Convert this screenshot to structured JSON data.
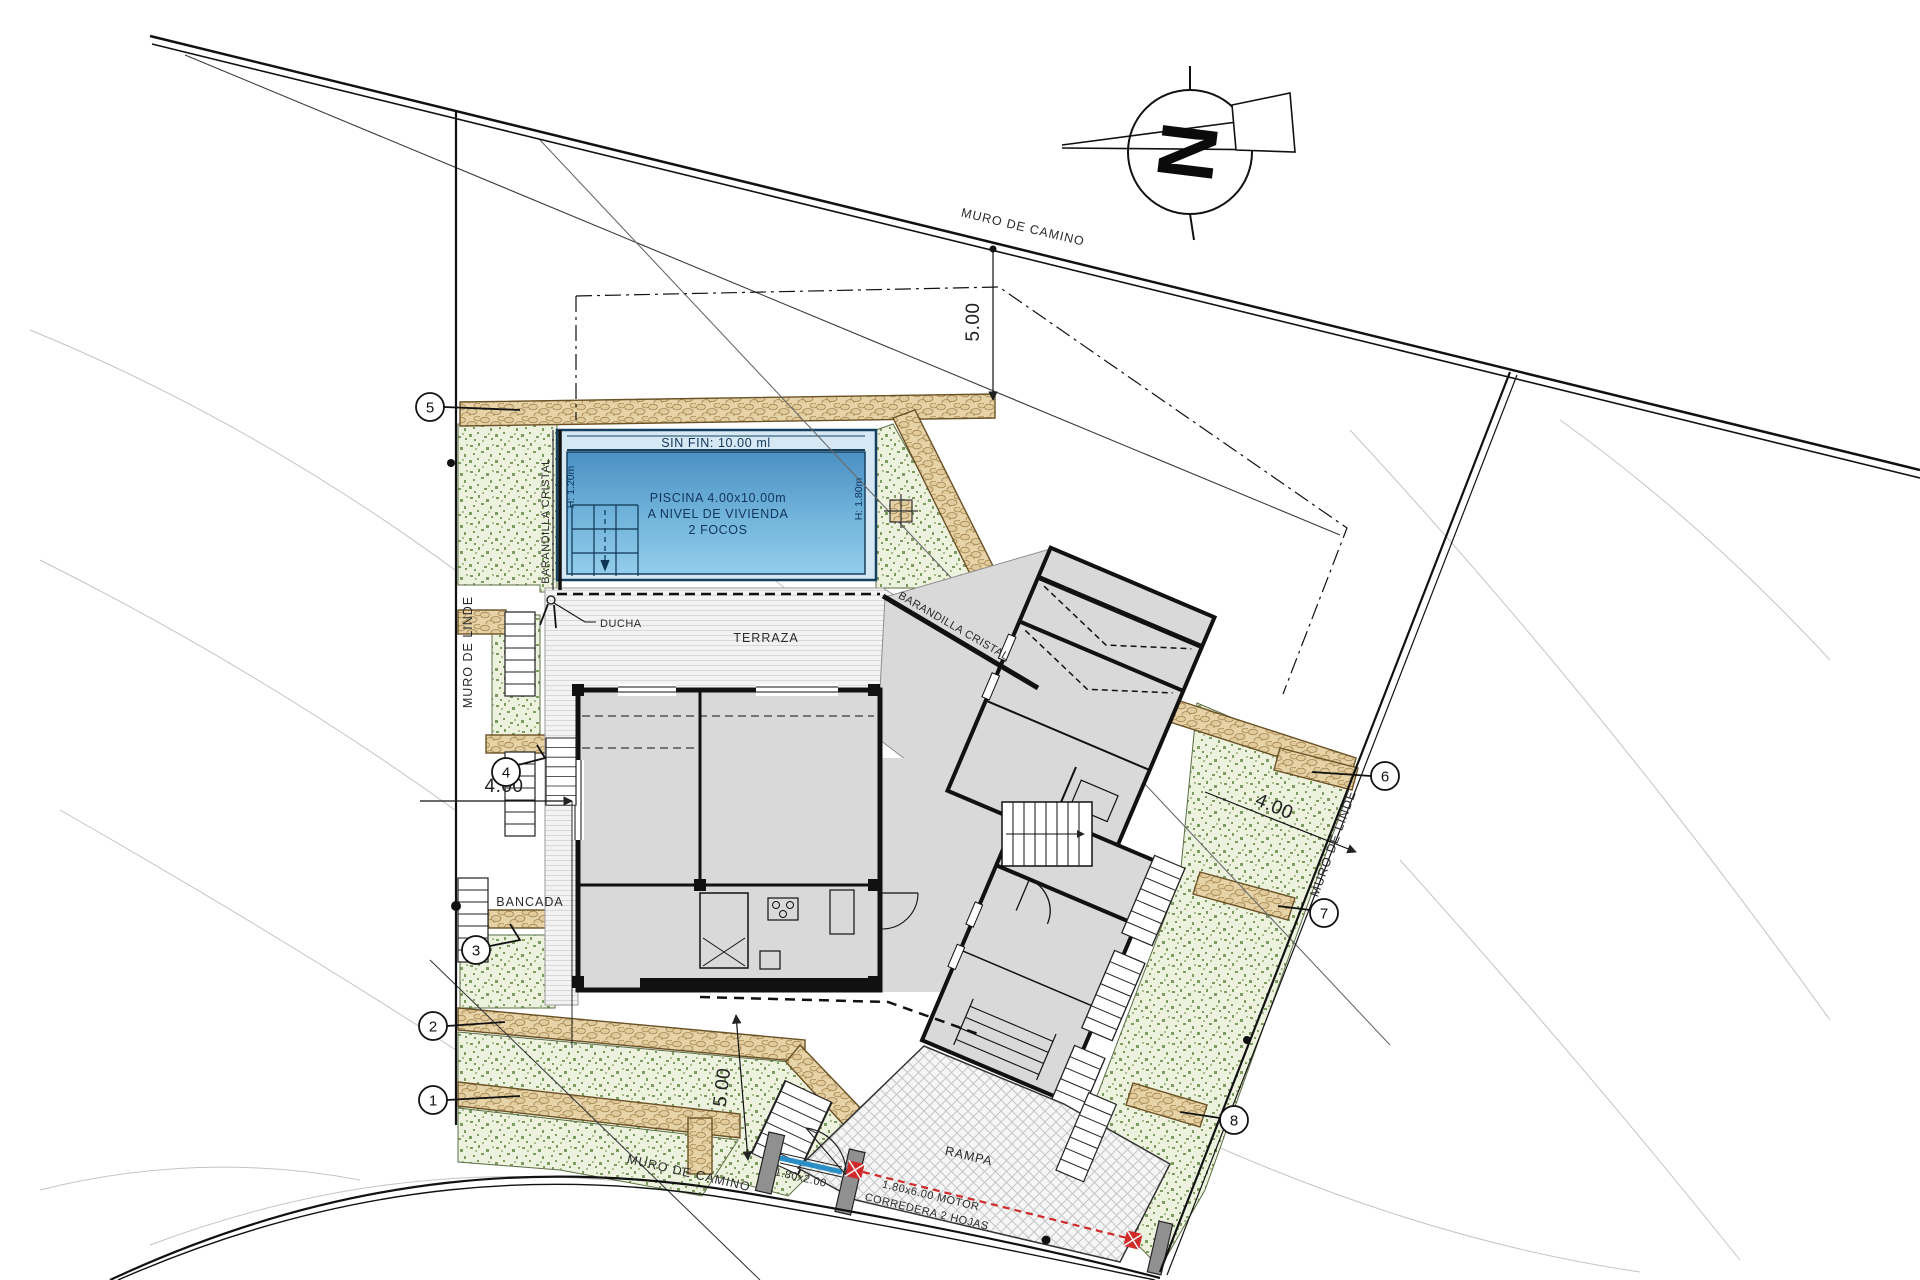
{
  "compass": {
    "north": "N"
  },
  "roads": {
    "top": "MURO DE CAMINO",
    "bottom": "MURO DE CAMINO"
  },
  "boundaries": {
    "left": "MURO DE LINDE",
    "right": "MURO DE LINDE"
  },
  "pool": {
    "edge": "SIN FIN: 10.00 ml",
    "name": "PISCINA 4.00x10.00m",
    "level": "A NIVEL DE VIVIENDA",
    "lights": "2 FOCOS",
    "depth_shallow": "H: 1.20m",
    "depth_deep": "H: 1.80m",
    "railing": "BARANDILLA CRISTAL"
  },
  "terrace": {
    "label": "TERRAZA",
    "railing": "BARANDILLA CRISTAL",
    "shower": "DUCHA",
    "bench": "BANCADA"
  },
  "ramp": {
    "label": "RAMPA"
  },
  "gates": {
    "pedestrian_size": "1.80x2.00",
    "sliding_size": "1.80x6.00 MOTOR",
    "sliding_type": "CORREDERA 2 HOJAS"
  },
  "dimensions": {
    "top_setback": "5.00",
    "left_width": "4.00",
    "right_setback": "4.00",
    "bottom_setback": "5.00"
  },
  "markers": [
    "1",
    "2",
    "3",
    "4",
    "5",
    "6",
    "7",
    "8"
  ],
  "colors": {
    "pool_dark": "#16405f",
    "pool_light": "#8cc6e8",
    "landscape_green": "#7d9c60",
    "wall_tan": "#e7d3a8",
    "building_gray": "#d9d9d9",
    "accent_red": "#cf2b2b"
  }
}
